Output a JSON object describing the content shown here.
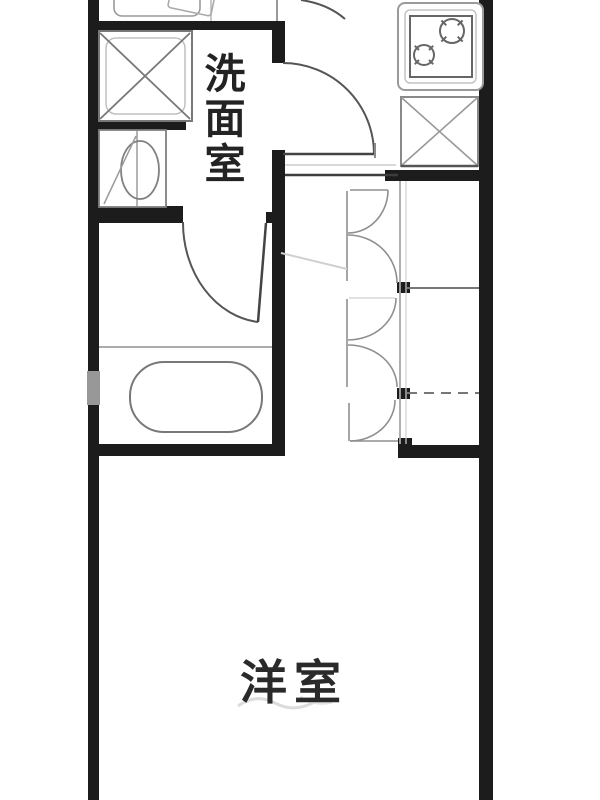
{
  "floor_plan": {
    "type": "japanese-apartment-floor-plan",
    "labels": {
      "washroom": "洗面室",
      "washroom_vertical": [
        "洗",
        "面",
        "室"
      ],
      "western_room": "洋室"
    },
    "rooms": [
      {
        "name": "washroom",
        "label": "洗面室"
      },
      {
        "name": "western-room",
        "label": "洋室"
      }
    ],
    "fixtures": [
      "washing-machine-pan",
      "toilet",
      "bathtub",
      "bathroom-door",
      "washroom-door",
      "gas-stove-two-burner",
      "refrigerator-space",
      "closet-bifold-doors",
      "entrance-door-arc"
    ],
    "colors": {
      "wall": "#1c1c1c",
      "door_line": "#555555",
      "fixture_line": "#808080",
      "label_text": "#232323",
      "background": "#ffffff"
    }
  }
}
